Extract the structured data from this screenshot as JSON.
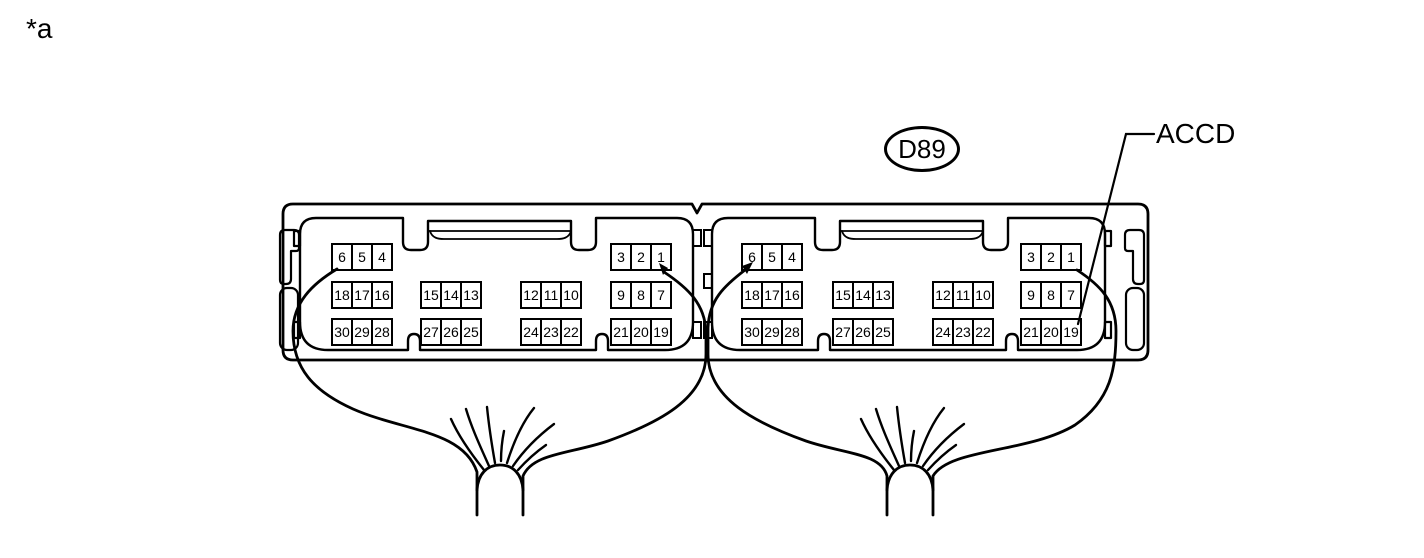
{
  "labels": {
    "footnote": "*a",
    "connector_code": "D89",
    "terminal_label": "ACCD"
  },
  "colors": {
    "line": "#000000",
    "background": "#ffffff"
  },
  "connectors": [
    {
      "name": "left half",
      "blocks": [
        {
          "pins": [
            "6",
            "5",
            "4"
          ]
        },
        {
          "pins": [
            "3",
            "2",
            "1"
          ]
        },
        {
          "pins": [
            "18",
            "17",
            "16"
          ]
        },
        {
          "pins": [
            "15",
            "14",
            "13"
          ]
        },
        {
          "pins": [
            "12",
            "11",
            "10"
          ]
        },
        {
          "pins": [
            "9",
            "8",
            "7"
          ]
        },
        {
          "pins": [
            "30",
            "29",
            "28"
          ]
        },
        {
          "pins": [
            "27",
            "26",
            "25"
          ]
        },
        {
          "pins": [
            "24",
            "23",
            "22"
          ]
        },
        {
          "pins": [
            "21",
            "20",
            "19"
          ]
        }
      ]
    },
    {
      "name": "right half",
      "blocks": [
        {
          "pins": [
            "6",
            "5",
            "4"
          ]
        },
        {
          "pins": [
            "3",
            "2",
            "1"
          ]
        },
        {
          "pins": [
            "18",
            "17",
            "16"
          ]
        },
        {
          "pins": [
            "15",
            "14",
            "13"
          ]
        },
        {
          "pins": [
            "12",
            "11",
            "10"
          ]
        },
        {
          "pins": [
            "9",
            "8",
            "7"
          ]
        },
        {
          "pins": [
            "30",
            "29",
            "28"
          ]
        },
        {
          "pins": [
            "27",
            "26",
            "25"
          ]
        },
        {
          "pins": [
            "24",
            "23",
            "22"
          ]
        },
        {
          "pins": [
            "21",
            "20",
            "19"
          ]
        }
      ]
    }
  ]
}
